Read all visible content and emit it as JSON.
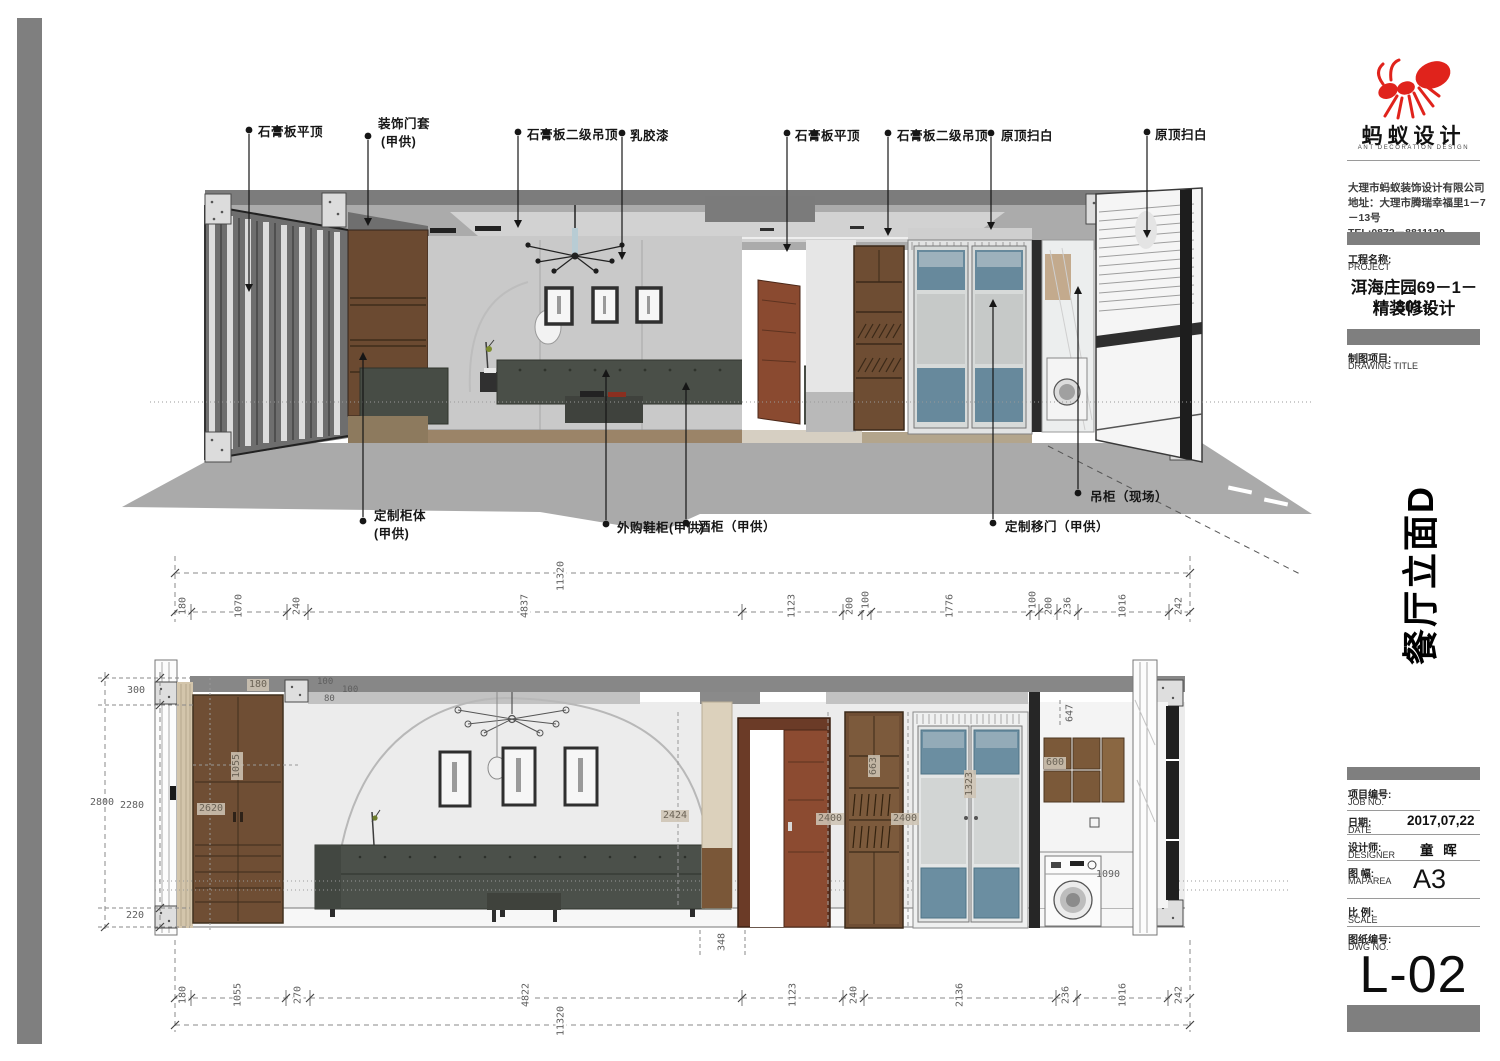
{
  "brand": {
    "name": "蚂蚁设计",
    "name_en": "ANT DECORATION DESIGN",
    "company": "大理市蚂蚁装饰设计有限公司",
    "address": "地址：大理市腾瑞幸福里1－7－13号",
    "tel": "TEL:0872－8811129",
    "logo_color": "#e0231c"
  },
  "project": {
    "label_cn": "工程名称:",
    "label_en": "PROJECT",
    "name_line1": "洱海庄园69－1－801#",
    "name_line2": "精装修设计"
  },
  "drawing": {
    "label_cn": "制图项目:",
    "label_en": "DRAWING TITLE",
    "elevation_title": "餐厅立面D"
  },
  "titleblock": {
    "job_cn": "项目编号:",
    "job_en": "JOB NO.",
    "date_cn": "日期:",
    "date_en": "DATE",
    "date_value": "2017,07,22",
    "designer_cn": "设计师:",
    "designer_en": "DESIGNER",
    "designer_value": "童 晖",
    "maparea_cn": "图 幅:",
    "maparea_en": "MAPAREA",
    "maparea_value": "A3",
    "scale_cn": "比 例:",
    "scale_en": "SCALE",
    "dwg_cn": "图纸编号:",
    "dwg_en": "DWG NO.",
    "dwg_value": "L-02"
  },
  "callouts": {
    "top": [
      {
        "label": "石膏板平顶"
      },
      {
        "label": "装饰门套",
        "label2": "(甲供)"
      },
      {
        "label": "石膏板二级吊顶"
      },
      {
        "label": "乳胶漆"
      },
      {
        "label": "石膏板平顶"
      },
      {
        "label": "石膏板二级吊顶"
      },
      {
        "label": "原顶扫白"
      },
      {
        "label": "原顶扫白"
      }
    ],
    "bottom": [
      {
        "label": "定制柜体",
        "label2": "(甲供)"
      },
      {
        "label": "外购鞋柜(甲供)"
      },
      {
        "label": "酒柜（甲供）"
      },
      {
        "label": "定制移门（甲供）"
      },
      {
        "label": "吊柜（现场）"
      }
    ]
  },
  "dims": {
    "top_chain": {
      "total": "11320",
      "segments": [
        "180",
        "1070",
        "240",
        "4837",
        "1123",
        "200",
        "100",
        "1776",
        "100",
        "200",
        "236",
        "1016",
        "242"
      ]
    },
    "bottom_chain": {
      "total": "11320",
      "segments": [
        "180",
        "1055",
        "270",
        "4822",
        "1123",
        "240",
        "2136",
        "236",
        "1016",
        "242"
      ]
    },
    "left_vertical": {
      "v300": "300",
      "v2800": "2800",
      "v2280": "2280",
      "v220": "220"
    },
    "interior": {
      "c180": "180",
      "c100a": "100",
      "c100b": "100",
      "c80": "80",
      "c1055": "1055",
      "c2620": "2620",
      "c2424": "2424",
      "c2400a": "2400",
      "c2400b": "2400",
      "c663": "663",
      "c1323": "1323",
      "c647": "647",
      "c600": "600",
      "c1090": "1090",
      "c348": "348"
    }
  }
}
